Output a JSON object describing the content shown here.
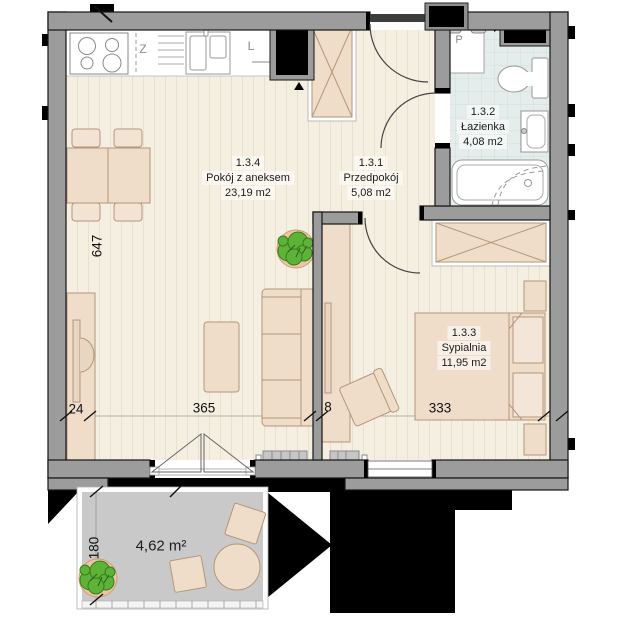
{
  "floorplan": {
    "rooms": [
      {
        "id": "1.3.4",
        "name": "Pokój z aneksem",
        "area": "23,19 m2"
      },
      {
        "id": "1.3.1",
        "name": "Przedpokój",
        "area": "5,08 m2"
      },
      {
        "id": "1.3.2",
        "name": "Łazienka",
        "area": "4,08 m2"
      },
      {
        "id": "1.3.3",
        "name": "Sypialnia",
        "area": "11,95 m2"
      }
    ],
    "balcony": {
      "area": "4,62 m²"
    },
    "dimensions": {
      "interior_height": "647",
      "tv_wall": "24",
      "living_width": "365",
      "partition": "8",
      "bedroom_width": "333",
      "balcony_depth": "180"
    },
    "appliance_letters": {
      "dish_zone": "Z",
      "fridge": "L",
      "washing_machine": "P"
    },
    "colors": {
      "wall": "#9c9c9c",
      "floor": "#f4efe1",
      "furniture": "#efddca",
      "bathroom_floor": "#e4edeb",
      "balcony_floor": "#c9c9c9",
      "plant_green": "#5db238",
      "mass_black": "#000000"
    }
  }
}
